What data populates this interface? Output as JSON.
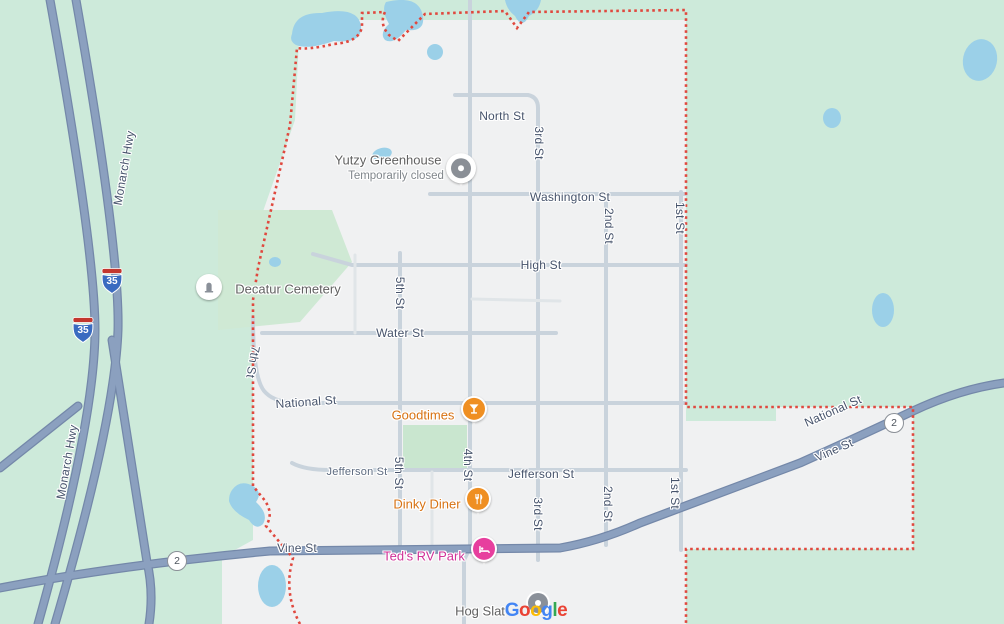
{
  "colors": {
    "land_green": "#cdeada",
    "town_gray": "#f0f1f2",
    "park_green": "#c9e6cf",
    "water_blue": "#9bd0e8",
    "highway_fill": "#8ba0bf",
    "highway_casing": "#7488a9",
    "local_road": "#c9d3dc",
    "minor_road": "#e3e8ea",
    "boundary_red": "#e0483e",
    "street_label": "#46536b",
    "poi_orange": "#d77213",
    "poi_pink": "#d03298",
    "poi_gray": "#616161"
  },
  "streets": {
    "north_st": "North St",
    "washington_st": "Washington St",
    "high_st": "High St",
    "water_st": "Water St",
    "national_st": "National St",
    "jefferson_st": "Jefferson St",
    "vine_st": "Vine St",
    "first_st": "1st St",
    "second_st": "2nd St",
    "third_st": "3rd St",
    "fourth_st": "4th St",
    "fifth_st": "5th St",
    "seventh_st": "7th St",
    "monarch_hwy": "Monarch Hwy"
  },
  "pois": {
    "yutzy": {
      "name": "Yutzy Greenhouse",
      "status": "Temporarily closed"
    },
    "decatur": {
      "name": "Decatur Cemetery"
    },
    "goodtimes": {
      "name": "Goodtimes"
    },
    "dinky_diner": {
      "name": "Dinky Diner"
    },
    "teds_rv": {
      "name": "Ted's RV Park"
    },
    "hog_slat": {
      "name": "Hog Slat"
    }
  },
  "shields": {
    "interstate_35": "35",
    "route_2": "2"
  },
  "google_logo": {
    "text": "Google",
    "letters": [
      "G",
      "o",
      "o",
      "g",
      "l",
      "e"
    ]
  }
}
